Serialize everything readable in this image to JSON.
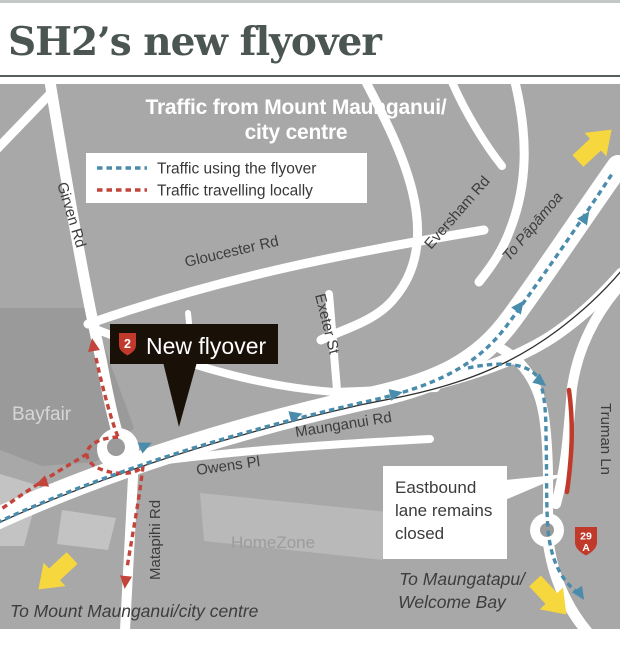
{
  "title": "SH2’s new flyover",
  "map": {
    "header": {
      "line1": "Traffic from Mount Maunganui/",
      "line2": "city centre"
    },
    "legend": {
      "items": [
        {
          "label": "Traffic using the flyover",
          "color": "#4a8cab"
        },
        {
          "label": "Traffic travelling locally",
          "color": "#c2443a"
        }
      ]
    },
    "roads": {
      "girven": "Girven Rd",
      "gloucester": "Gloucester Rd",
      "eversham": "Eversham Rd",
      "exeter": "Exeter St",
      "maunganui": "Maunganui Rd",
      "owens": "Owens Pl",
      "matapihi": "Matapihi Rd",
      "truman": "Truman Ln"
    },
    "destinations": {
      "papamoa": "To Pāpāmoa",
      "mount_maunganui": "To Mount Maunganui/city centre",
      "maungatapu_line1": "To Maungatapu/",
      "maungatapu_line2": "Welcome Bay"
    },
    "places": {
      "bayfair": "Bayfair",
      "homezone": "HomeZone"
    },
    "callouts": {
      "new_flyover": {
        "shield": "2",
        "label": "New flyover"
      },
      "eastbound": {
        "line1": "Eastbound",
        "line2": "lane remains",
        "line3": "closed"
      }
    },
    "shields": {
      "sh29a_top": "29",
      "sh29a_bottom": "A"
    },
    "colors": {
      "flyover_route": "#4a8cab",
      "local_route": "#c2443a",
      "closed_lane": "#c0392b",
      "direction_arrow": "#f6d73e",
      "map_background": "#a8a8a8",
      "road": "#ffffff",
      "callout_background": "#191008",
      "shield_red": "#c0392b",
      "title_color": "#4b5551"
    }
  }
}
